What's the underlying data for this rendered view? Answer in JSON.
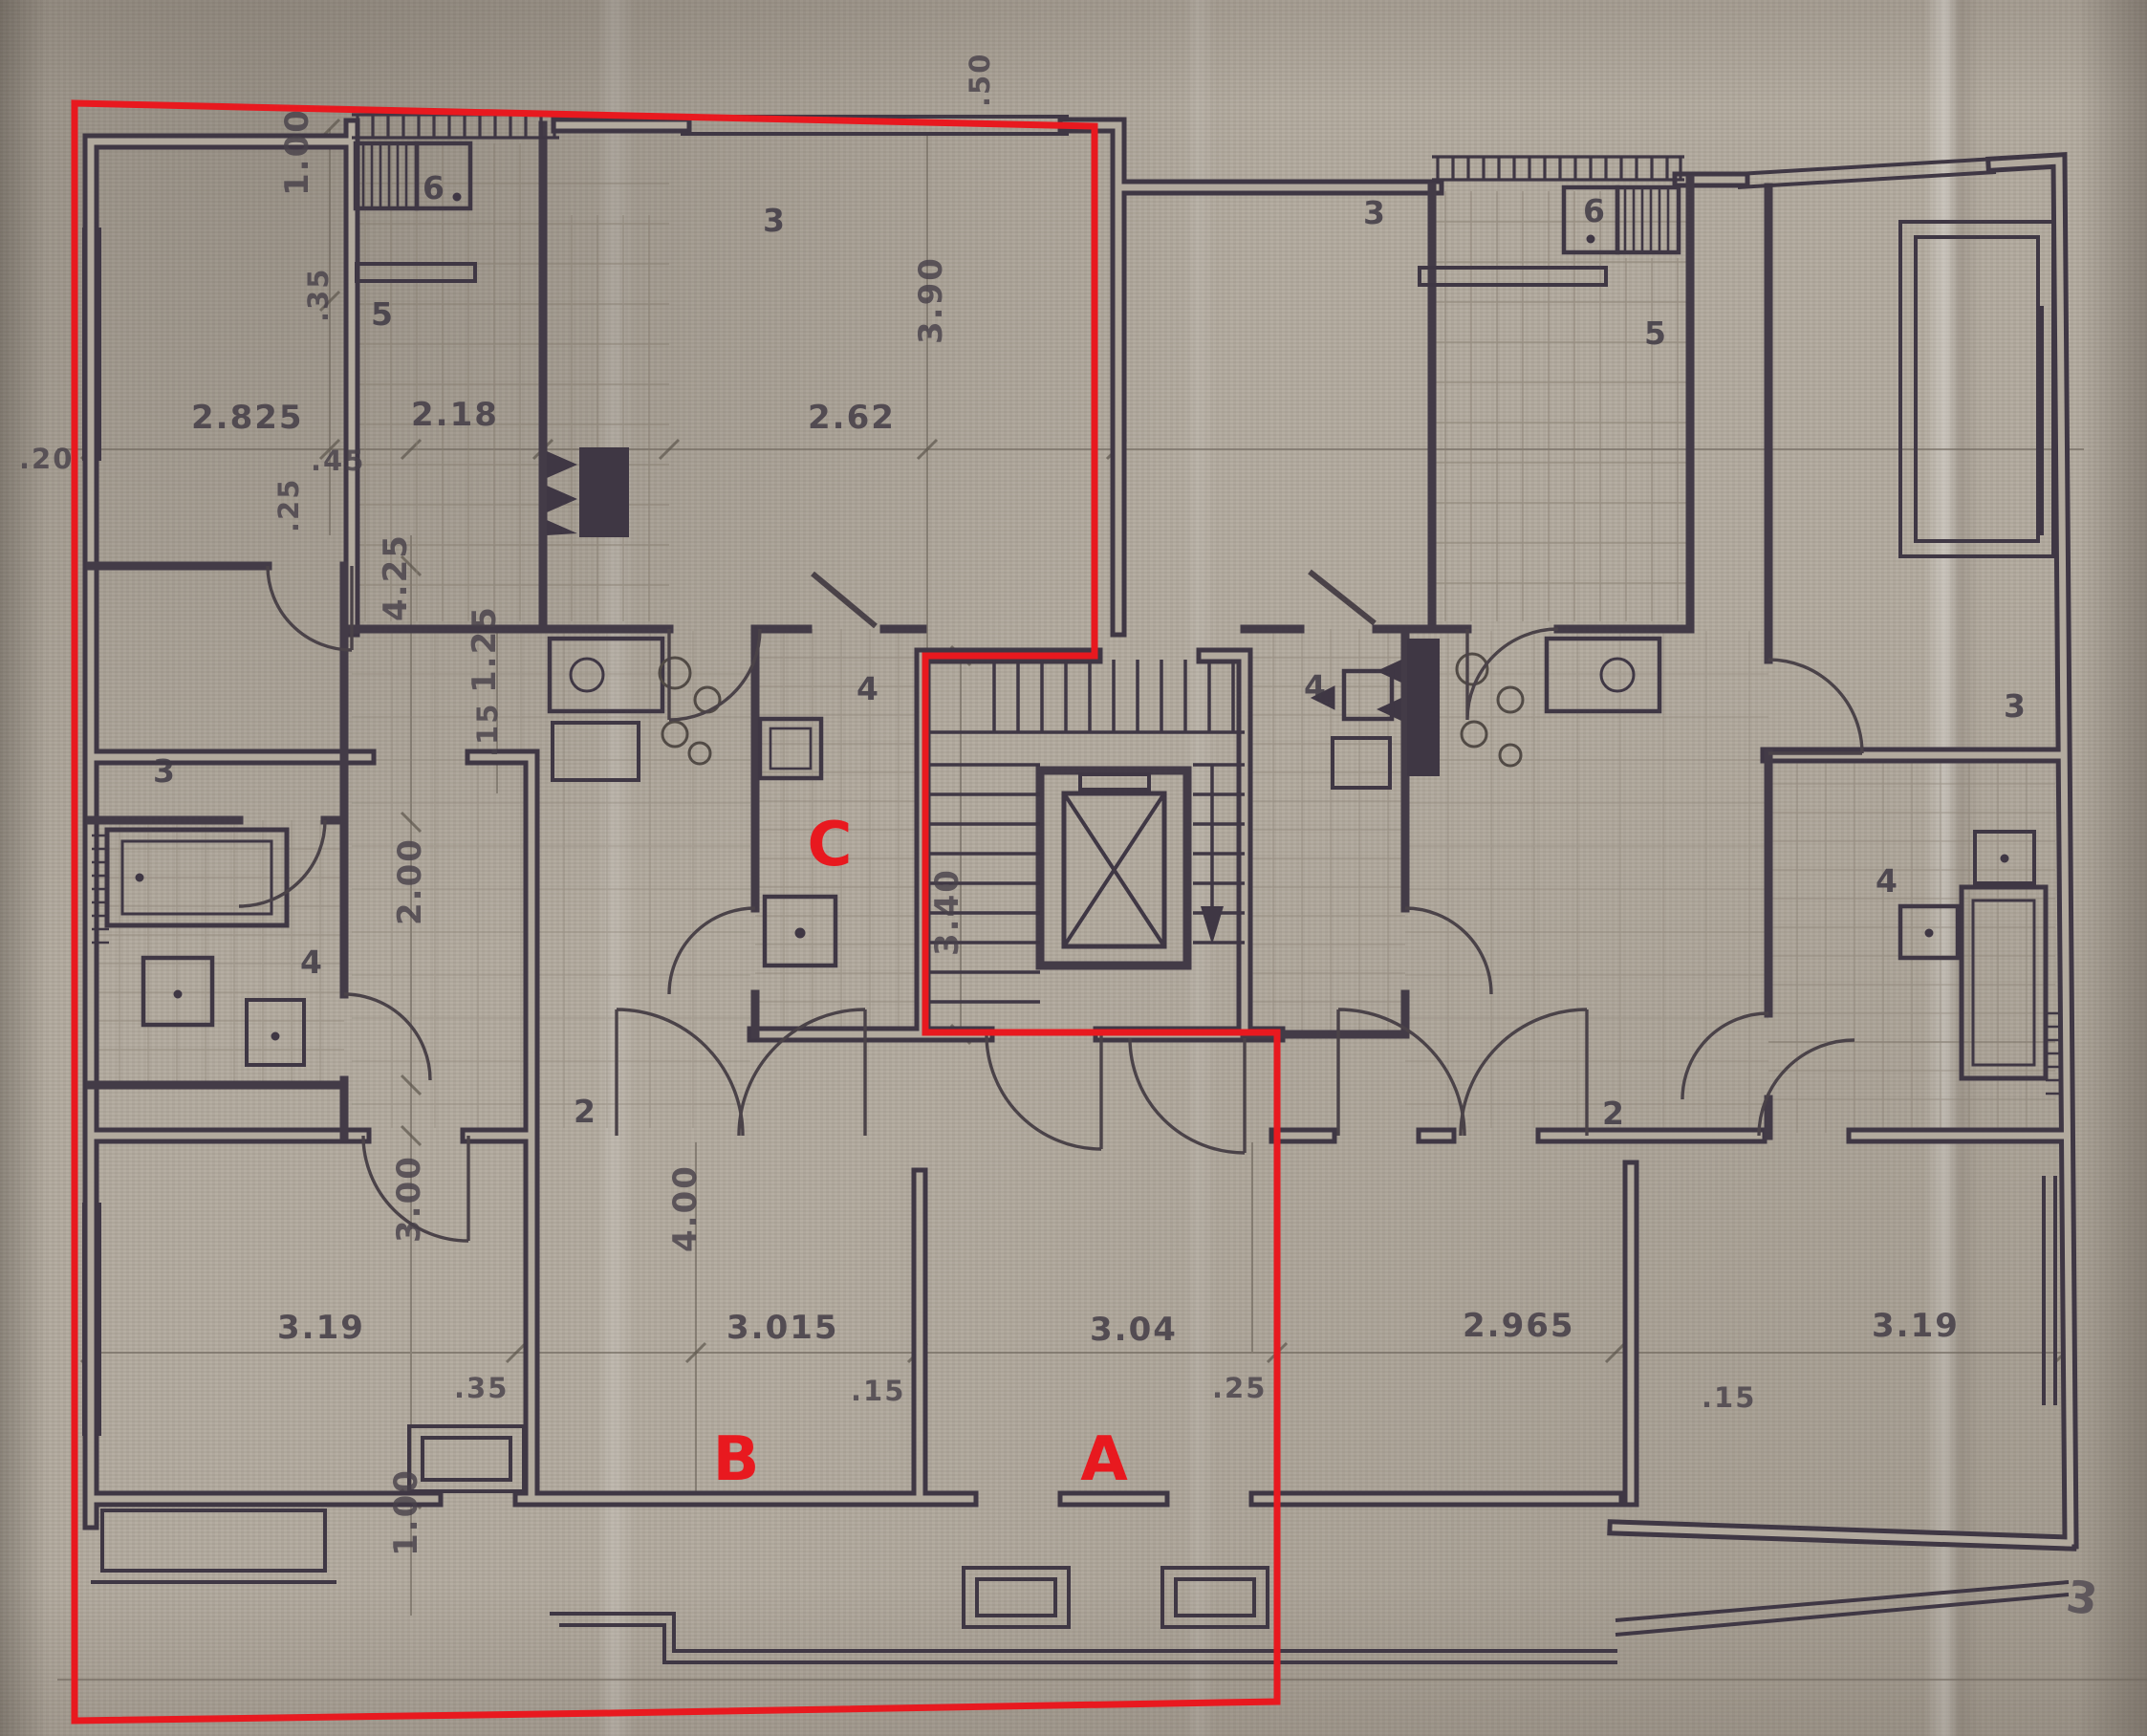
{
  "annotation": {
    "color": "#e8191f",
    "region_labels": [
      {
        "id": "A",
        "text": "A"
      },
      {
        "id": "B",
        "text": "B"
      },
      {
        "id": "C",
        "text": "C"
      }
    ]
  },
  "dims": [
    {
      "t": "2.825"
    },
    {
      "t": "2.18"
    },
    {
      "t": "2.62"
    },
    {
      "t": ".20"
    },
    {
      "t": ".45"
    },
    {
      "t": ".35"
    },
    {
      "t": "1.00"
    },
    {
      "t": ".25"
    },
    {
      "t": "4.25"
    },
    {
      "t": "2.00"
    },
    {
      "t": "3.00"
    },
    {
      "t": "1.00"
    },
    {
      "t": "1.25"
    },
    {
      "t": ".15"
    },
    {
      "t": "3.90"
    },
    {
      "t": ".50"
    },
    {
      "t": "3.40"
    },
    {
      "t": "4.00"
    },
    {
      "t": "3.19"
    },
    {
      "t": ".35"
    },
    {
      "t": "3.015"
    },
    {
      "t": ".15"
    },
    {
      "t": "3.04"
    },
    {
      "t": ".25"
    },
    {
      "t": "2.965"
    },
    {
      "t": ".15"
    },
    {
      "t": "3.19"
    }
  ],
  "rooms": [
    {
      "t": "6"
    },
    {
      "t": "5"
    },
    {
      "t": "3"
    },
    {
      "t": "4"
    },
    {
      "t": "4"
    },
    {
      "t": "3"
    },
    {
      "t": "2"
    },
    {
      "t": "3"
    },
    {
      "t": "6"
    },
    {
      "t": "5"
    },
    {
      "t": "4"
    },
    {
      "t": "2"
    },
    {
      "t": "3"
    },
    {
      "t": "4"
    },
    {
      "t": "3"
    }
  ],
  "colors": {
    "paper": "#b2aa9e",
    "ink": "#3f3744",
    "pencil": "#6e665c",
    "red": "#e8191f"
  }
}
